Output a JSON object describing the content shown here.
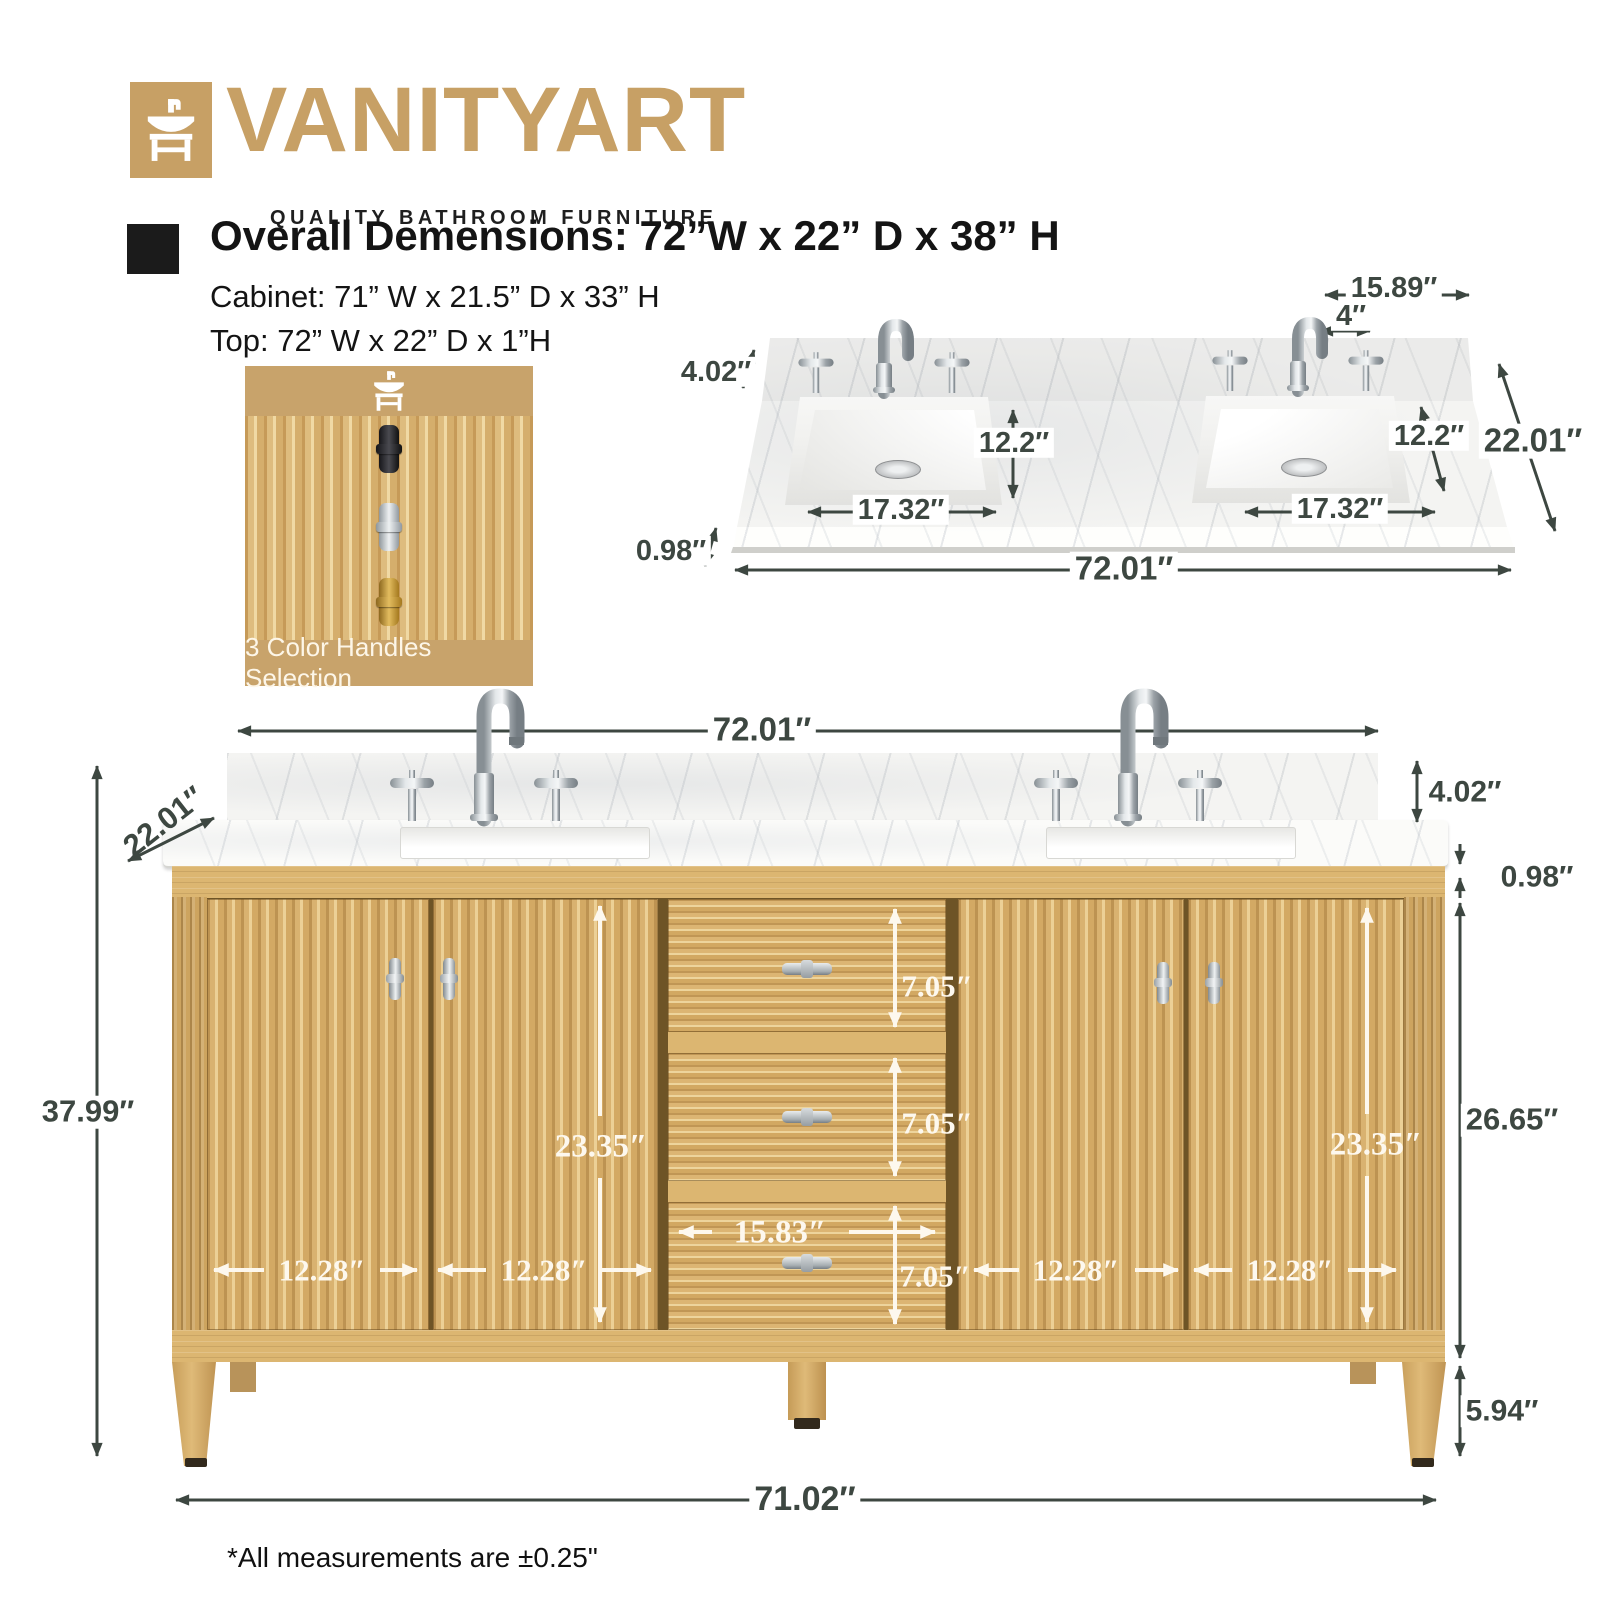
{
  "brand": {
    "name": "VANITYART",
    "tagline": "QUALITY BATHROOM FURNITURE",
    "icon": "vanity-sink-icon",
    "color_tan": "#c7a065"
  },
  "specs": {
    "overall": "Overall Demensions: 72”W x 22” D x 38” H",
    "cabinet": "Cabinet: 71” W x 21.5” D x 33” H",
    "top": "Top: 72” W x 22” D x 1”H"
  },
  "swatch": {
    "caption": "3 Color Handles Selection",
    "handles": [
      "black",
      "chrome",
      "gold"
    ]
  },
  "countertop_diagram": {
    "dims": {
      "backsplash_return_width": "15.89″",
      "faucet_hole_spacing": "4″",
      "backsplash_height": "4.02″",
      "sink_depth_left": "12.2″",
      "sink_depth_right": "12.2″",
      "top_depth": "22.01″",
      "sink_width_left": "17.32″",
      "sink_width_right": "17.32″",
      "top_thickness": "0.98″",
      "top_width": "72.01″"
    }
  },
  "vanity_diagram": {
    "dims": {
      "top_width": "72.01″",
      "top_depth": "22.01″",
      "overall_height": "37.99″",
      "backsplash_height": "4.02″",
      "top_thickness": "0.98″",
      "cabinet_height": "26.65″",
      "leg_height": "5.94″",
      "base_width": "71.02″",
      "door_height_left": "23.35″",
      "door_height_right": "23.35″",
      "drawer_1_height": "7.05″",
      "drawer_2_height": "7.05″",
      "drawer_3_height": "7.05″",
      "drawer_width": "15.83″",
      "door_1_width": "12.28″",
      "door_2_width": "12.28″",
      "door_3_width": "12.28″",
      "door_4_width": "12.28″"
    }
  },
  "footnote": "*All measurements are ±0.25\""
}
